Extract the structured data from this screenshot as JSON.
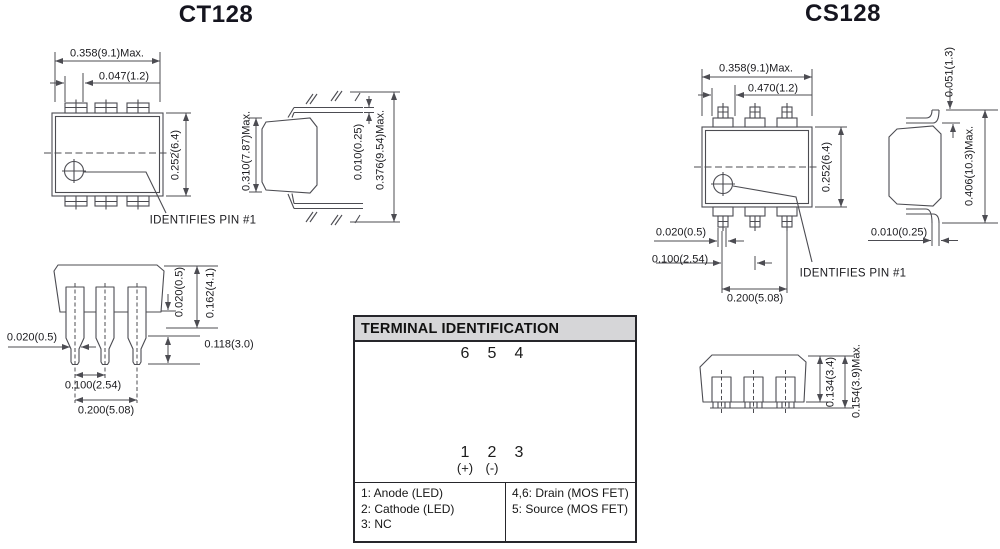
{
  "ct128": {
    "title": "CT128",
    "front": {
      "width": "0.358(9.1)Max.",
      "pin_offset": "0.047(1.2)",
      "height": "0.252(6.4)",
      "pin1_note": "IDENTIFIES PIN #1"
    },
    "side": {
      "body_height": "0.310(7.87)Max.",
      "lead_thickness": "0.010(0.25)",
      "overall_height": "0.376(9.54)Max."
    },
    "bottom": {
      "lead_width": "0.020(0.5)",
      "standoff": "0.020(0.5)",
      "shoulder_length": "0.162(4.1)",
      "lead_length": "0.118(3.0)",
      "pitch": "0.100(2.54)",
      "span": "0.200(5.08)"
    }
  },
  "cs128": {
    "title": "CS128",
    "front": {
      "width": "0.358(9.1)Max.",
      "pin_offset": "0.470(1.2)",
      "height": "0.252(6.4)",
      "lead_width": "0.020(0.5)",
      "pitch": "0.100(2.54)",
      "span": "0.200(5.08)",
      "pin1_note": "IDENTIFIES PIN #1"
    },
    "side": {
      "lead_top": "0.051(1.3)",
      "overall_height": "0.406(10.3)Max.",
      "lead_thickness": "0.010(0.25)"
    },
    "bottom": {
      "body_height": "0.134(3.4)",
      "overall": "0.154(3.9)Max."
    }
  },
  "terminal": {
    "title": "TERMINAL IDENTIFICATION",
    "pins_top": [
      "6",
      "5",
      "4"
    ],
    "pins_bottom": [
      "1",
      "2",
      "3"
    ],
    "plus": "(+)",
    "minus": "(-)",
    "legend_left": [
      "1: Anode (LED)",
      "2: Cathode (LED)",
      "3: NC"
    ],
    "legend_right": [
      "4,6: Drain (MOS FET)",
      "5: Source (MOS FET)"
    ]
  },
  "colors": {
    "line": "#4c4c52",
    "text": "#1a1a1e",
    "header_bg": "#d6d6d8"
  }
}
